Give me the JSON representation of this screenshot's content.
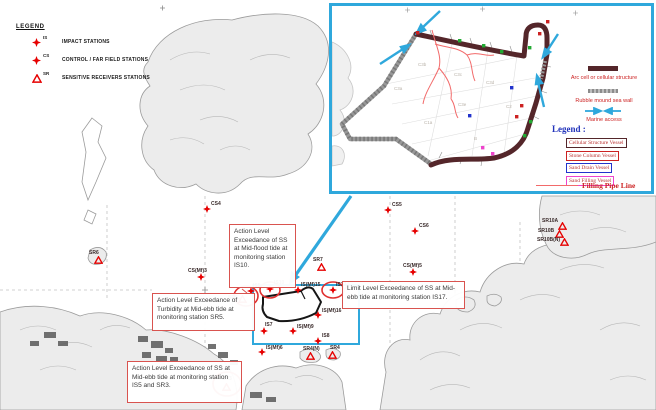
{
  "colors": {
    "station_red": "#e60000",
    "circle_red": "#e03030",
    "annotation_border": "#d9534f",
    "inset_border": "#2fa8dc",
    "arc_cell": "#54262a",
    "sea_wall": "#979797",
    "marine_access": "#2fa8dc",
    "pipe_line": "#f26a6a",
    "legend_blue": "#2233bb"
  },
  "legend": {
    "title": "LEGEND",
    "items": [
      {
        "code": "IS",
        "symbol": "star",
        "label": "IMPACT STATIONS"
      },
      {
        "code": "CS",
        "symbol": "star",
        "label": "CONTROL / FAR FIELD STATIONS"
      },
      {
        "code": "SR",
        "symbol": "triangle",
        "label": "SENSITIVE RECEIVERS STATIONS"
      }
    ]
  },
  "inset": {
    "legend_title": "Legend :",
    "line_items": [
      {
        "label": "Arc cell or cellular structure",
        "swatch": "arc-cell"
      },
      {
        "label": "Rubble mound sea wall",
        "swatch": "sea-wall"
      },
      {
        "label": "Marine access",
        "swatch": "arrows"
      }
    ],
    "vessel_boxes": [
      {
        "label": "Cellular Structure Vessel",
        "border": "#54262a"
      },
      {
        "label": "Stone Column Vessel",
        "border": "#cc2222"
      },
      {
        "label": "Sand Drain Vessel",
        "border": "#2233cc"
      },
      {
        "label": "Sand Filling Vessel",
        "border": "#ee44cc"
      }
    ],
    "pipe_item": {
      "label": "Filling Pipe Line"
    },
    "area_labels": [
      {
        "text": "C3b",
        "x": 86,
        "y": 56
      },
      {
        "text": "C3c",
        "x": 122,
        "y": 66
      },
      {
        "text": "C3d",
        "x": 154,
        "y": 74
      },
      {
        "text": "C3a",
        "x": 62,
        "y": 80
      },
      {
        "text": "C3e",
        "x": 126,
        "y": 96
      },
      {
        "text": "C2",
        "x": 174,
        "y": 98
      },
      {
        "text": "C1a",
        "x": 92,
        "y": 114
      },
      {
        "text": "B",
        "x": 142,
        "y": 130
      }
    ],
    "vessel_markers": [
      {
        "x": 126,
        "y": 33,
        "c": "#22aa33"
      },
      {
        "x": 150,
        "y": 38,
        "c": "#22aa33"
      },
      {
        "x": 168,
        "y": 44,
        "c": "#22aa33"
      },
      {
        "x": 196,
        "y": 40,
        "c": "#22aa33"
      },
      {
        "x": 197,
        "y": 114,
        "c": "#22aa33"
      },
      {
        "x": 191,
        "y": 128,
        "c": "#22aa33"
      },
      {
        "x": 84,
        "y": 25,
        "c": "#cc2222"
      },
      {
        "x": 214,
        "y": 14,
        "c": "#cc2222"
      },
      {
        "x": 206,
        "y": 26,
        "c": "#cc2222"
      },
      {
        "x": 188,
        "y": 98,
        "c": "#cc2222"
      },
      {
        "x": 183,
        "y": 109,
        "c": "#cc2222"
      },
      {
        "x": 178,
        "y": 80,
        "c": "#2233cc"
      },
      {
        "x": 136,
        "y": 108,
        "c": "#2233cc"
      },
      {
        "x": 149,
        "y": 140,
        "c": "#ee44cc"
      },
      {
        "x": 159,
        "y": 146,
        "c": "#ee44cc"
      }
    ]
  },
  "annotations": [
    {
      "text": "Action Level Exceedance of SS at Mid-flood tide at monitoring station IS10."
    },
    {
      "text": "Action Level Exceedance of Turbidity at Mid-ebb tide at monitoring station SR5."
    },
    {
      "text": "Action Level Exceedance of SS at Mid-ebb tide at monitoring station IS5 and SR3."
    },
    {
      "text": "Limit Level Exceedance of SS at Mid-ebb tide at monitoring station IS17."
    }
  ],
  "stations": [
    {
      "id": "CS4",
      "type": "star",
      "x": 207,
      "y": 209,
      "dx": 4,
      "dy": -8
    },
    {
      "id": "CS5",
      "type": "star",
      "x": 388,
      "y": 210,
      "dx": 4,
      "dy": -8
    },
    {
      "id": "CS6",
      "type": "star",
      "x": 415,
      "y": 231,
      "dx": 4,
      "dy": -8
    },
    {
      "id": "CS(Mf)3",
      "type": "star",
      "x": 201,
      "y": 277,
      "dx": -13,
      "dy": -9
    },
    {
      "id": "CS(Mf)5",
      "type": "star",
      "x": 413,
      "y": 272,
      "dx": -10,
      "dy": -9
    },
    {
      "id": "SR6",
      "type": "triangle",
      "x": 98,
      "y": 260,
      "dx": -9,
      "dy": -10
    },
    {
      "id": "SR7",
      "type": "triangle",
      "x": 321,
      "y": 267,
      "dx": -8,
      "dy": -10
    },
    {
      "id": "IS10",
      "type": "star",
      "x": 270,
      "y": 289,
      "dx": 4,
      "dy": -9
    },
    {
      "id": "IS5",
      "type": "star",
      "x": 251,
      "y": 291,
      "dx": 2,
      "dy": -8
    },
    {
      "id": "SR5",
      "type": "triangle",
      "x": 242,
      "y": 299,
      "dx": -14,
      "dy": -4
    },
    {
      "id": "IS(Mf)15",
      "type": "star",
      "x": 298,
      "y": 290,
      "dx": 3,
      "dy": -8
    },
    {
      "id": "IS17",
      "type": "star",
      "x": 333,
      "y": 290,
      "dx": 3,
      "dy": -8
    },
    {
      "id": "IS(Mf)16",
      "type": "star",
      "x": 318,
      "y": 315,
      "dx": 4,
      "dy": -7
    },
    {
      "id": "IS7",
      "type": "star",
      "x": 264,
      "y": 331,
      "dx": 1,
      "dy": -9
    },
    {
      "id": "IS(Mf)9",
      "type": "star",
      "x": 293,
      "y": 331,
      "dx": 4,
      "dy": -7
    },
    {
      "id": "IS8",
      "type": "star",
      "x": 318,
      "y": 341,
      "dx": 4,
      "dy": -8
    },
    {
      "id": "IS(Mf)6",
      "type": "star",
      "x": 262,
      "y": 352,
      "dx": 4,
      "dy": -7
    },
    {
      "id": "SR4(N)",
      "type": "triangle",
      "x": 310,
      "y": 356,
      "dx": -7,
      "dy": -10
    },
    {
      "id": "SR4",
      "type": "triangle",
      "x": 332,
      "y": 355,
      "dx": -2,
      "dy": -10
    },
    {
      "id": "SR3",
      "type": "triangle",
      "x": 226,
      "y": 387,
      "dx": -4,
      "dy": -11
    },
    {
      "id": "SR10A",
      "type": "triangle",
      "x": 562,
      "y": 226,
      "dx": -20,
      "dy": -8
    },
    {
      "id": "SR10B",
      "type": "triangle",
      "x": 559,
      "y": 234,
      "dx": -21,
      "dy": -6
    },
    {
      "id": "SR10B(N)",
      "type": "triangle",
      "x": 564,
      "y": 242,
      "dx": -27,
      "dy": -5
    }
  ],
  "exceedance_circles": [
    {
      "cx": 270,
      "cy": 290,
      "rx": 10,
      "ry": 8
    },
    {
      "cx": 246,
      "cy": 296,
      "rx": 12,
      "ry": 10
    },
    {
      "cx": 333,
      "cy": 290,
      "rx": 11,
      "ry": 8
    },
    {
      "cx": 227,
      "cy": 384,
      "rx": 14,
      "ry": 12
    }
  ]
}
